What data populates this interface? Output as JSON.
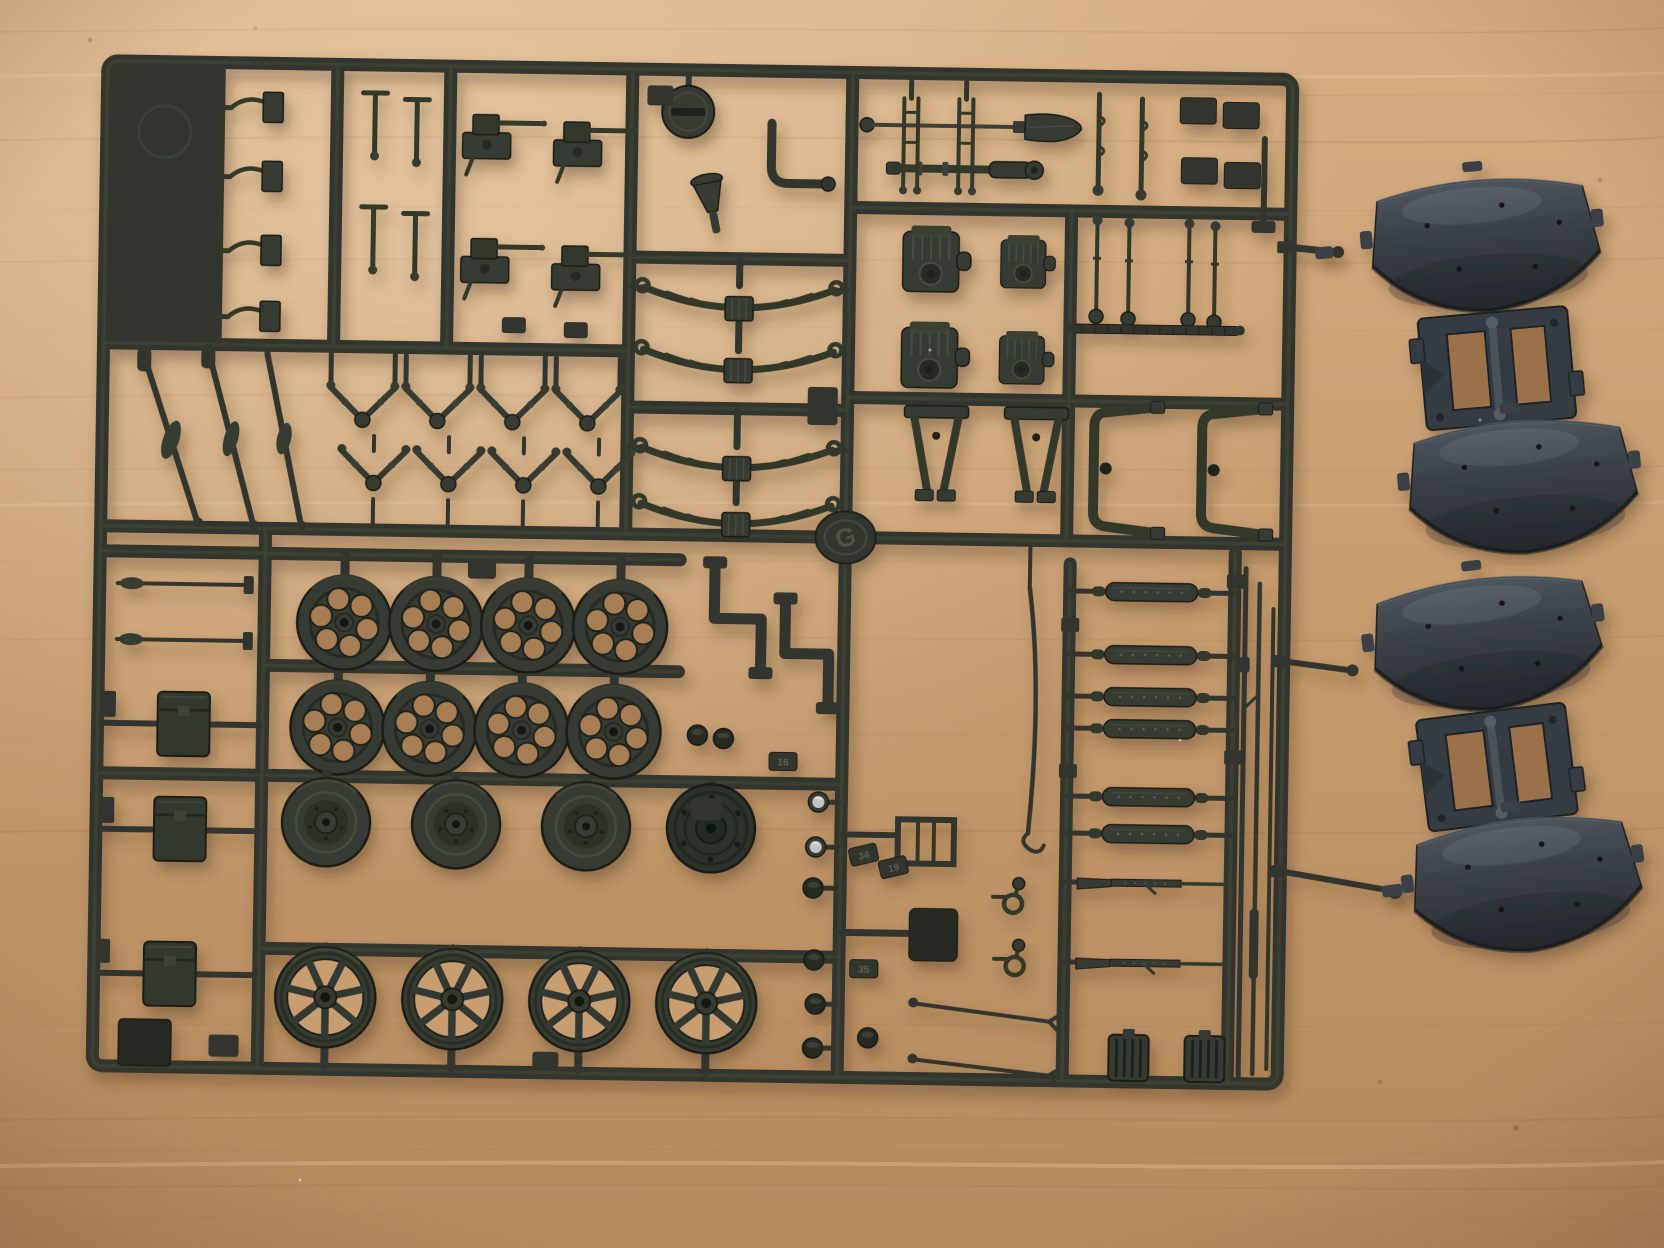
{
  "scene": {
    "type": "photograph",
    "subject": "Dark grey injection-moulded sprue (runner) of a scale model kit with suspension, wheel and tool parts, plus two separate fender runners, lying on a light wooden desk",
    "items": [
      "main parts sprue",
      "upper fender runner",
      "lower fender runner"
    ]
  },
  "colors": {
    "wood_light": "#d9b286",
    "wood_mid": "#c89e70",
    "wood_dark": "#b2875a",
    "wood_grain": "#9c6f46",
    "plastic": "#31362d",
    "plastic_light": "#49513f",
    "plastic_dark": "#1c201a",
    "fender": "#3a4046",
    "fender_light": "#5c666f",
    "fender_dark": "#23272c",
    "lens": "#c2c5c8"
  },
  "sprue": {
    "letter": "G",
    "number_tabs": [
      "16",
      "34",
      "19",
      "35"
    ],
    "part_groups": [
      {
        "name": "pedal levers",
        "count": 4
      },
      {
        "name": "gun cradles",
        "count": 4
      },
      {
        "name": "leaf springs",
        "count": 4
      },
      {
        "name": "v-shaped linkages",
        "count": 8
      },
      {
        "name": "tie rods",
        "count": 3
      },
      {
        "name": "gearbox housings",
        "count": 4
      },
      {
        "name": "gear levers",
        "count": 4
      },
      {
        "name": "frame brackets",
        "count": 4
      },
      {
        "name": "road wheels with lightening holes",
        "count": 8
      },
      {
        "name": "disc wheels",
        "count": 4
      },
      {
        "name": "spoked wheels",
        "count": 4
      },
      {
        "name": "storage boxes",
        "count": 4
      },
      {
        "name": "shock absorber cylinders",
        "count": 6
      },
      {
        "name": "rifles",
        "count": 2
      },
      {
        "name": "barrel rods",
        "count": 3
      },
      {
        "name": "radiator grilles",
        "count": 2
      },
      {
        "name": "headlight caps",
        "count": 6
      },
      {
        "name": "tow shackles",
        "count": 2
      },
      {
        "name": "shovel",
        "count": 1
      },
      {
        "name": "gun barrel with rings",
        "count": 1
      },
      {
        "name": "funnel",
        "count": 1
      },
      {
        "name": "slotted filler cap",
        "count": 1
      }
    ]
  },
  "fender_runners": {
    "count": 2,
    "fenders_per_runner": 2,
    "description": "Separate darker grey runners, each holding two curved fender shells joined by a flat chassis bracket"
  }
}
